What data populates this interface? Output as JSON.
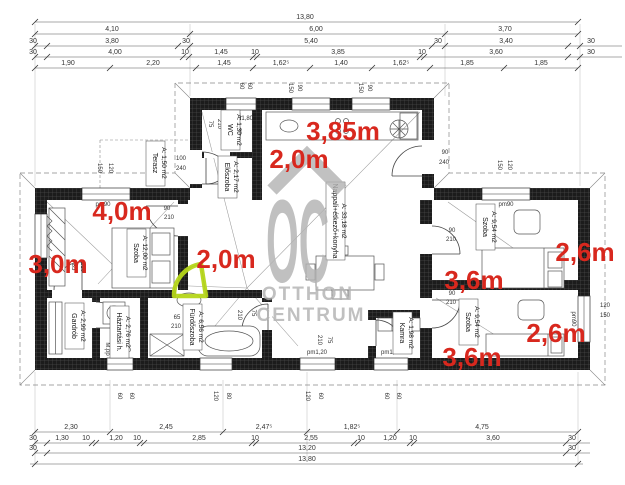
{
  "watermark": {
    "logo": "OC",
    "line1": "OTTHON",
    "line2": "CENTRUM"
  },
  "red_measurements": [
    "3,85m",
    "2,0m",
    "4,0m",
    "3,0m",
    "2,0m",
    "2,6m",
    "3,6m",
    "2,6m",
    "3,6m"
  ],
  "rooms": {
    "terasz": {
      "name": "Terasz",
      "area": "A: 1,50 m2"
    },
    "wc": {
      "name": "WC",
      "area": "A: 1,30 m2"
    },
    "eloszoba": {
      "name": "Előszoba",
      "area": "A: 2,17 m2"
    },
    "szoba1": {
      "name": "Szoba",
      "area": "A: 12,00 m2"
    },
    "gardrob": {
      "name": "Gardrób",
      "area": "A: 2,99 m2"
    },
    "haztartasi": {
      "name": "Háztartási h.",
      "area": "A: 2,76 m2"
    },
    "furdoszoba": {
      "name": "Fürdőszoba",
      "area": "A: 6,56 m2"
    },
    "nappali": {
      "name": "Nappali+étkező+konyha",
      "area": "A: 33,18 m2"
    },
    "kamra": {
      "name": "Kamra",
      "area": "A: 1,98 m2"
    },
    "szoba2": {
      "name": "Szoba",
      "area": "A: 9,54 m2"
    },
    "szoba3": {
      "name": "Szoba",
      "area": "A: 9,54 m2"
    }
  },
  "window_labels": {
    "pm90": "pm90",
    "pm120": "pm1,20",
    "pm180": "pm1,80"
  },
  "size_labels": {
    "s60": "60",
    "s65": "65",
    "s75": "75",
    "s80": "80",
    "s85": "85",
    "s90": "90",
    "s100": "100",
    "s120": "120",
    "s150": "150",
    "s210": "210",
    "s240": "240",
    "s180": "1,80",
    "mpp": "M.pp"
  },
  "dims": {
    "top": {
      "r1": [
        "13,80"
      ],
      "r2": [
        "4,10",
        "6,00",
        "3,70"
      ],
      "r3": [
        "30",
        "3,80",
        "30",
        "5,40",
        "30",
        "3,40",
        "30"
      ],
      "r4": [
        "30",
        "4,00",
        "10",
        "1,45",
        "10",
        "3,85",
        "10",
        "3,60",
        "30"
      ],
      "r5": [
        "1,90",
        "2,20",
        "1,45",
        "1,62⁵",
        "1,40",
        "1,62⁵",
        "1,85",
        "1,85"
      ]
    },
    "bottom": {
      "r1": [
        "2,30",
        "2,45",
        "2,47⁵",
        "1,82⁵",
        "4,75"
      ],
      "r2": [
        "30",
        "1,30",
        "10",
        "1,20",
        "10",
        "2,85",
        "10",
        "2,55",
        "10",
        "1,20",
        "10",
        "3,60",
        "30"
      ],
      "r3": [
        "30",
        "13,20",
        "30"
      ],
      "r4": [
        "13,80"
      ]
    }
  },
  "colors": {
    "red_annotation": "#d8281e",
    "green_highlight": "#b5d619",
    "wall": "#1c1c1c",
    "watermark": "#b3b3b3"
  }
}
